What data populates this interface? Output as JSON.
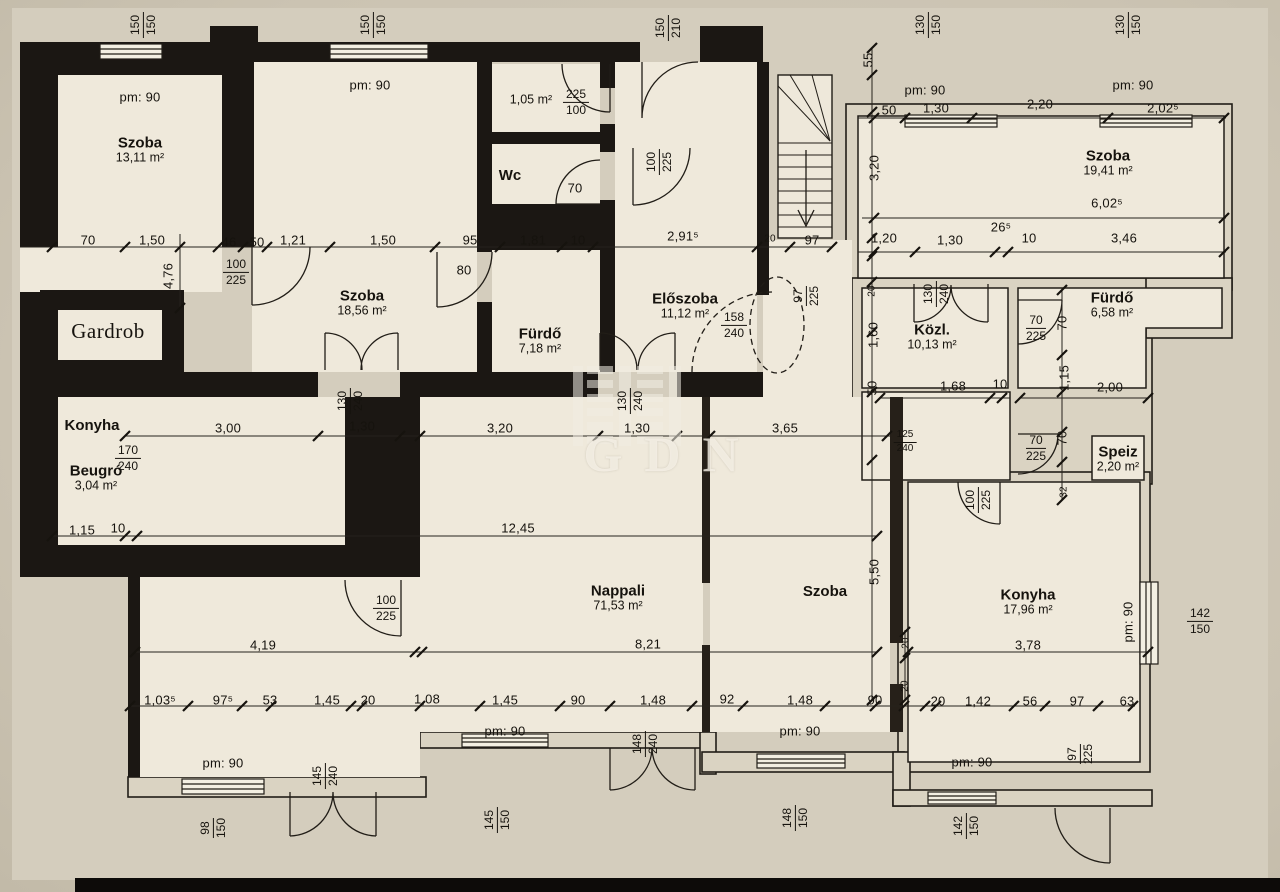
{
  "watermark": {
    "text": "GDN"
  },
  "rooms": [
    {
      "name": "Szoba",
      "area": "13,11 m²",
      "x": 140,
      "y": 150
    },
    {
      "name": "",
      "area": "1,05 m²",
      "x": 531,
      "y": 100
    },
    {
      "name": "Wc",
      "area": "",
      "x": 510,
      "y": 176
    },
    {
      "name": "Szoba",
      "area": "18,56 m²",
      "x": 362,
      "y": 303
    },
    {
      "name": "Fürdő",
      "area": "7,18 m²",
      "x": 540,
      "y": 341
    },
    {
      "name": "Előszoba",
      "area": "11,12 m²",
      "x": 685,
      "y": 306
    },
    {
      "name": "Szoba",
      "area": "19,41 m²",
      "x": 1108,
      "y": 163
    },
    {
      "name": "Közl.",
      "area": "10,13 m²",
      "x": 932,
      "y": 337
    },
    {
      "name": "Fürdő",
      "area": "6,58 m²",
      "x": 1112,
      "y": 305
    },
    {
      "name": "Speiz",
      "area": "2,20 m²",
      "x": 1118,
      "y": 459
    },
    {
      "name": "Gardrob",
      "area": "",
      "x": 108,
      "y": 331,
      "style": "serif"
    },
    {
      "name": "Konyha",
      "area": "",
      "x": 92,
      "y": 426
    },
    {
      "name": "Beugró",
      "area": "3,04 m²",
      "x": 96,
      "y": 478
    },
    {
      "name": "Nappali",
      "area": "71,53 m²",
      "x": 618,
      "y": 598
    },
    {
      "name": "Szoba",
      "area": "",
      "x": 825,
      "y": 592
    },
    {
      "name": "Konyha",
      "area": "17,96 m²",
      "x": 1028,
      "y": 602
    }
  ],
  "dims": [
    {
      "t": "pm: 90",
      "x": 140,
      "y": 97
    },
    {
      "t": "pm: 90",
      "x": 370,
      "y": 85
    },
    {
      "t": "pm: 90",
      "x": 925,
      "y": 90
    },
    {
      "t": "pm: 90",
      "x": 1133,
      "y": 85
    },
    {
      "t": "pm: 90",
      "x": 505,
      "y": 731
    },
    {
      "t": "pm: 90",
      "x": 800,
      "y": 731
    },
    {
      "t": "pm: 90",
      "x": 972,
      "y": 762
    },
    {
      "t": "pm: 90",
      "x": 223,
      "y": 763
    },
    {
      "t": "pm: 90",
      "x": 1128,
      "y": 622,
      "r": -90
    },
    {
      "t": "70",
      "x": 88,
      "y": 240
    },
    {
      "t": "1,50",
      "x": 152,
      "y": 240
    },
    {
      "t": "46",
      "x": 229,
      "y": 242
    },
    {
      "t": "50",
      "x": 257,
      "y": 242
    },
    {
      "t": "1,21",
      "x": 293,
      "y": 240
    },
    {
      "t": "1,50",
      "x": 383,
      "y": 240
    },
    {
      "t": "95",
      "x": 470,
      "y": 240
    },
    {
      "t": "1,81",
      "x": 533,
      "y": 240
    },
    {
      "t": "10",
      "x": 578,
      "y": 240
    },
    {
      "t": "2,91⁵",
      "x": 683,
      "y": 236
    },
    {
      "t": "20",
      "x": 770,
      "y": 239,
      "s": 1
    },
    {
      "t": "97",
      "x": 812,
      "y": 240
    },
    {
      "t": "50",
      "x": 889,
      "y": 110
    },
    {
      "t": "1,30",
      "x": 936,
      "y": 108
    },
    {
      "t": "2,20",
      "x": 1040,
      "y": 104
    },
    {
      "t": "2,02⁵",
      "x": 1163,
      "y": 108
    },
    {
      "t": "6,02⁵",
      "x": 1107,
      "y": 203
    },
    {
      "t": "26⁵",
      "x": 1001,
      "y": 227
    },
    {
      "t": "1,20",
      "x": 884,
      "y": 238
    },
    {
      "t": "1,30",
      "x": 950,
      "y": 240
    },
    {
      "t": "10",
      "x": 1029,
      "y": 238
    },
    {
      "t": "3,46",
      "x": 1124,
      "y": 238
    },
    {
      "t": "55",
      "x": 868,
      "y": 60,
      "r": -90
    },
    {
      "t": "3,20",
      "x": 874,
      "y": 168,
      "r": -90
    },
    {
      "t": "4,76",
      "x": 168,
      "y": 276,
      "r": -90
    },
    {
      "t": "20",
      "x": 872,
      "y": 291,
      "r": -90,
      "s": 1
    },
    {
      "t": "1,60",
      "x": 873,
      "y": 335,
      "r": -90
    },
    {
      "t": "50",
      "x": 872,
      "y": 388,
      "r": -90
    },
    {
      "t": "5,50",
      "x": 874,
      "y": 572,
      "r": -90
    },
    {
      "t": "70",
      "x": 1062,
      "y": 323,
      "r": -90
    },
    {
      "t": "1,15",
      "x": 1064,
      "y": 378,
      "r": -90
    },
    {
      "t": "70",
      "x": 1062,
      "y": 438,
      "r": -90
    },
    {
      "t": "32",
      "x": 1064,
      "y": 492,
      "r": -90,
      "s": 1
    },
    {
      "t": "20",
      "x": 906,
      "y": 643,
      "r": -90,
      "s": 1
    },
    {
      "t": "20",
      "x": 905,
      "y": 686,
      "r": -90,
      "s": 1
    },
    {
      "t": "70",
      "x": 575,
      "y": 188
    },
    {
      "t": "80",
      "x": 464,
      "y": 270
    },
    {
      "t": "3,00",
      "x": 228,
      "y": 428
    },
    {
      "t": "1,30",
      "x": 362,
      "y": 426
    },
    {
      "t": "3,20",
      "x": 500,
      "y": 428
    },
    {
      "t": "1,30",
      "x": 637,
      "y": 428
    },
    {
      "t": "3,65",
      "x": 785,
      "y": 428
    },
    {
      "t": "1,68",
      "x": 953,
      "y": 386
    },
    {
      "t": "10",
      "x": 1000,
      "y": 384
    },
    {
      "t": "2,00",
      "x": 1110,
      "y": 387
    },
    {
      "t": "1,15",
      "x": 82,
      "y": 530
    },
    {
      "t": "10",
      "x": 118,
      "y": 528
    },
    {
      "t": "12,45",
      "x": 518,
      "y": 528
    },
    {
      "t": "4,19",
      "x": 263,
      "y": 645
    },
    {
      "t": "8,21",
      "x": 648,
      "y": 644
    },
    {
      "t": "3,78",
      "x": 1028,
      "y": 645
    },
    {
      "t": "1,03⁵",
      "x": 160,
      "y": 700
    },
    {
      "t": "97⁵",
      "x": 223,
      "y": 700
    },
    {
      "t": "53",
      "x": 270,
      "y": 700
    },
    {
      "t": "1,45",
      "x": 327,
      "y": 700
    },
    {
      "t": "20",
      "x": 368,
      "y": 700
    },
    {
      "t": "1,08",
      "x": 427,
      "y": 699
    },
    {
      "t": "1,45",
      "x": 505,
      "y": 700
    },
    {
      "t": "90",
      "x": 578,
      "y": 700
    },
    {
      "t": "1,48",
      "x": 653,
      "y": 700
    },
    {
      "t": "92",
      "x": 727,
      "y": 699
    },
    {
      "t": "1,48",
      "x": 800,
      "y": 700
    },
    {
      "t": "90",
      "x": 875,
      "y": 700
    },
    {
      "t": "20",
      "x": 938,
      "y": 701
    },
    {
      "t": "1,42",
      "x": 978,
      "y": 701
    },
    {
      "t": "56",
      "x": 1030,
      "y": 701
    },
    {
      "t": "97",
      "x": 1077,
      "y": 701
    },
    {
      "t": "63",
      "x": 1127,
      "y": 701
    }
  ],
  "fracs": [
    {
      "a": "150",
      "b": "150",
      "x": 143,
      "y": 25,
      "r": -90
    },
    {
      "a": "150",
      "b": "150",
      "x": 373,
      "y": 25,
      "r": -90
    },
    {
      "a": "150",
      "b": "210",
      "x": 668,
      "y": 28,
      "r": -90
    },
    {
      "a": "130",
      "b": "150",
      "x": 928,
      "y": 25,
      "r": -90
    },
    {
      "a": "130",
      "b": "150",
      "x": 1128,
      "y": 25,
      "r": -90
    },
    {
      "a": "100",
      "b": "225",
      "x": 236,
      "y": 272
    },
    {
      "a": "225",
      "b": "100",
      "x": 576,
      "y": 102
    },
    {
      "a": "100",
      "b": "225",
      "x": 659,
      "y": 162,
      "r": -90
    },
    {
      "a": "158",
      "b": "240",
      "x": 734,
      "y": 325
    },
    {
      "a": "97",
      "b": "225",
      "x": 806,
      "y": 296,
      "r": -90
    },
    {
      "a": "130",
      "b": "240",
      "x": 350,
      "y": 401,
      "r": -90
    },
    {
      "a": "130",
      "b": "240",
      "x": 630,
      "y": 401,
      "r": -90
    },
    {
      "a": "130",
      "b": "240",
      "x": 936,
      "y": 294,
      "r": -90
    },
    {
      "a": "70",
      "b": "225",
      "x": 1036,
      "y": 328
    },
    {
      "a": "70",
      "b": "225",
      "x": 1036,
      "y": 448
    },
    {
      "a": "125",
      "b": "240",
      "x": 905,
      "y": 442,
      "s": 1
    },
    {
      "a": "100",
      "b": "225",
      "x": 978,
      "y": 500,
      "r": -90
    },
    {
      "a": "170",
      "b": "240",
      "x": 128,
      "y": 458
    },
    {
      "a": "100",
      "b": "225",
      "x": 386,
      "y": 608
    },
    {
      "a": "98",
      "b": "150",
      "x": 213,
      "y": 828,
      "r": -90
    },
    {
      "a": "145",
      "b": "240",
      "x": 325,
      "y": 776,
      "r": -90
    },
    {
      "a": "145",
      "b": "150",
      "x": 497,
      "y": 820,
      "r": -90
    },
    {
      "a": "148",
      "b": "240",
      "x": 645,
      "y": 744,
      "r": -90
    },
    {
      "a": "148",
      "b": "150",
      "x": 795,
      "y": 818,
      "r": -90
    },
    {
      "a": "142",
      "b": "150",
      "x": 966,
      "y": 826,
      "r": -90
    },
    {
      "a": "97",
      "b": "225",
      "x": 1080,
      "y": 754,
      "r": -90
    },
    {
      "a": "142",
      "b": "150",
      "x": 1200,
      "y": 621
    }
  ]
}
